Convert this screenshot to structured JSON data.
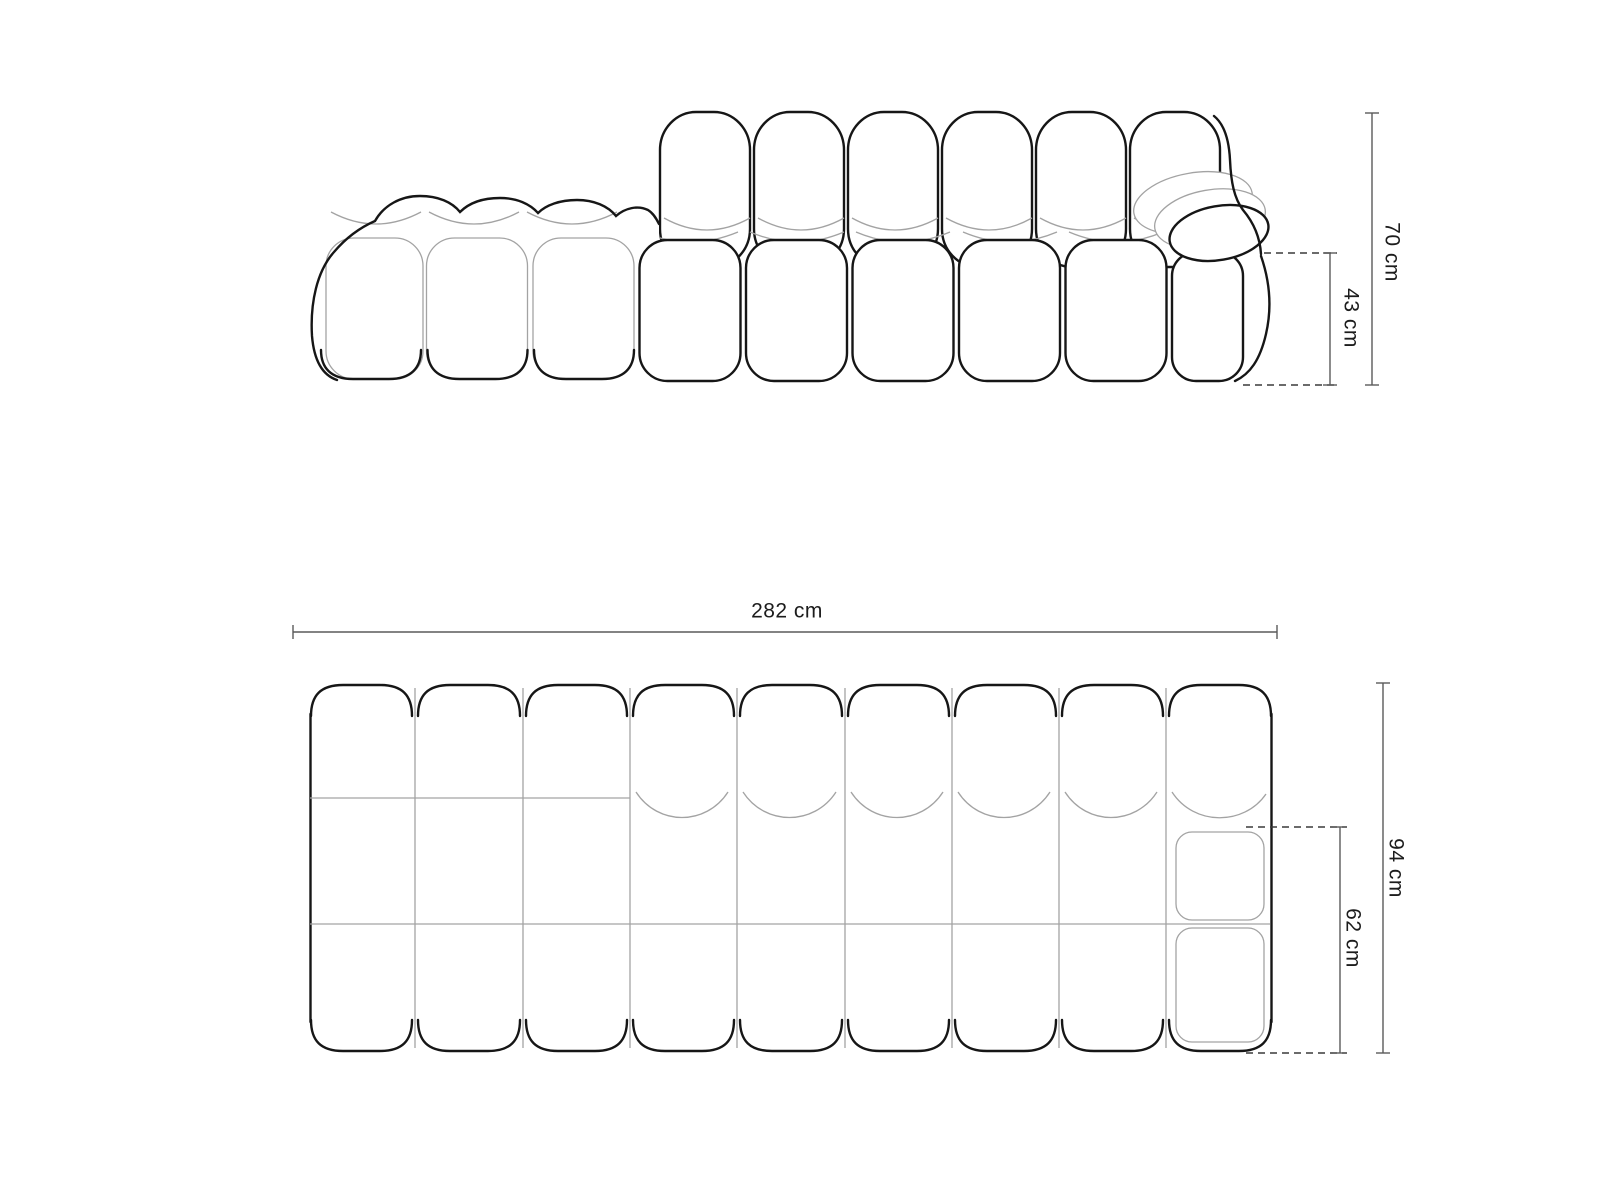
{
  "theme": {
    "background": "#ffffff",
    "outline_color": "#161616",
    "seam_color": "#a3a3a3",
    "dimension_line_color": "#5a5a5a",
    "label_color": "#1c1c1c"
  },
  "drawing": {
    "views": {
      "front_elevation": {
        "dimensions": {
          "total_height": {
            "value": 70,
            "unit": "cm",
            "label": "70 cm"
          },
          "seat_height": {
            "value": 43,
            "unit": "cm",
            "label": "43 cm"
          }
        }
      },
      "top_plan": {
        "dimensions": {
          "total_width": {
            "value": 282,
            "unit": "cm",
            "label": "282 cm"
          },
          "total_depth": {
            "value": 94,
            "unit": "cm",
            "label": "94 cm"
          },
          "seat_depth": {
            "value": 62,
            "unit": "cm",
            "label": "62 cm"
          }
        }
      }
    }
  }
}
